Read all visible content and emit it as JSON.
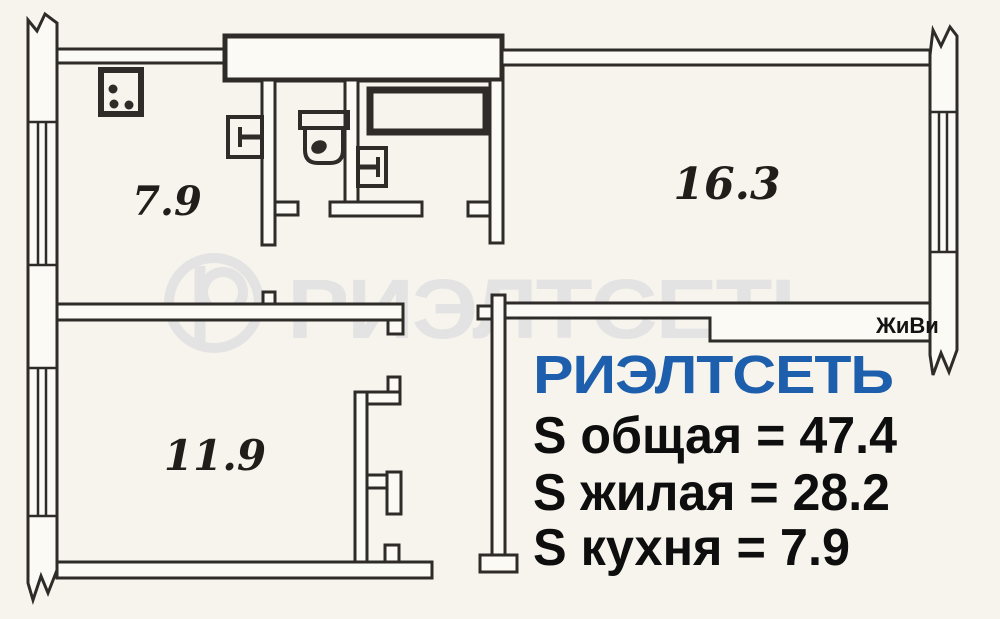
{
  "plan": {
    "rooms": [
      {
        "name": "kitchen",
        "area": "7.9"
      },
      {
        "name": "living-room",
        "area": "16.3"
      },
      {
        "name": "bedroom",
        "area": "11.9"
      }
    ],
    "tag": "ЖиВи"
  },
  "watermark": {
    "logo": "registered-r-circle-logo",
    "text": "РИЭЛТСЕТЬ",
    "color": "#e3e3e3"
  },
  "info": {
    "brand": "РИЭЛТСЕТЬ",
    "brand_color": "#1d5fac",
    "total_area_line": "S общая = 47.4",
    "living_area_line": "S жилая = 28.2",
    "kitchen_area_line": "S кухня = 7.9"
  },
  "colors": {
    "background": "#f7f4ee",
    "ink": "#2e2b28"
  }
}
